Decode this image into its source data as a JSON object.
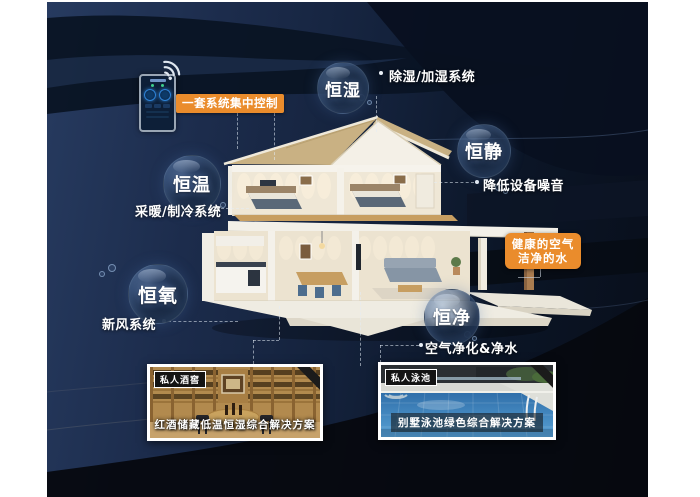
{
  "colors": {
    "accent_orange": "#ea8c2c",
    "background_navy": "#1c2c4c",
    "deep_navy": "#080e1a",
    "text_white": "#ffffff",
    "roof_tan": "#c9b183",
    "wood_brown": "#b28a4e",
    "pool_blue": "#3c7fb8",
    "dial_glow_blue": "#2f84d8"
  },
  "control_panel": {
    "banner_label": "一套系统集中控制",
    "wifi_icon": "wifi-icon",
    "phone_icon": "smart-home-app-phone"
  },
  "bubbles": [
    {
      "label": "恒湿",
      "system": "除湿/加湿系统"
    },
    {
      "label": "恒静",
      "system": "降低设备噪音"
    },
    {
      "label": "恒温",
      "system": "采暖/制冷系统"
    },
    {
      "label": "恒氧",
      "system": "新风系统"
    },
    {
      "label": "恒净",
      "system": "空气净化&净水"
    }
  ],
  "highlight_box": {
    "line1": "健康的空气",
    "line2": "洁净的水"
  },
  "photos": [
    {
      "tag": "私人酒窖",
      "caption": "红酒储藏低温恒湿综合解决方案"
    },
    {
      "tag": "私人泳池",
      "caption": "别墅泳池绿色综合解决方案"
    }
  ]
}
